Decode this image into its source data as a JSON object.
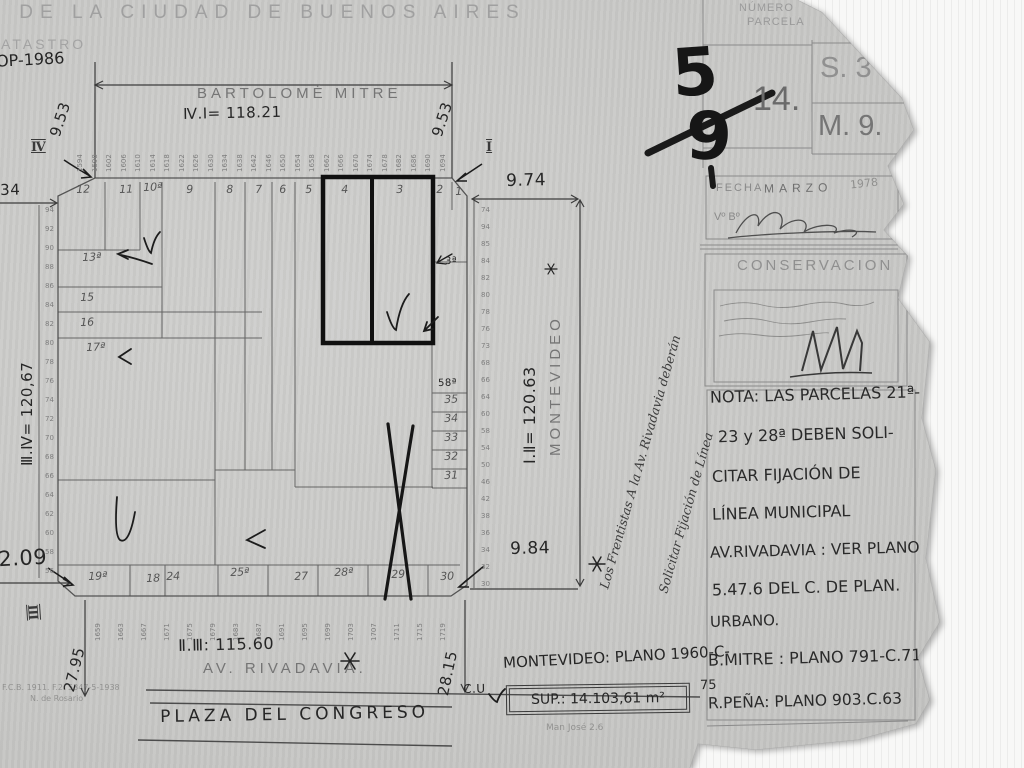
{
  "document": {
    "title": "ID DE LA CIUDAD DE BUENOS AIRES",
    "dept": "CATASTRO",
    "plan_code": "OP-1986",
    "numero_label": "NÚMERO",
    "parcela_label": "PARCELA",
    "hoja_num": "5",
    "hoja_den": "9",
    "circ": "14.",
    "seccion": "S. 3",
    "manzana": "M. 9.",
    "fecha_label": "FECHA",
    "mes": "MARZO",
    "anio": "1978",
    "vb": "Vº Bº",
    "conservacion_title": "CONSERVACION"
  },
  "nota": {
    "lines": [
      {
        "t": "NOTA: LAS PARCELAS 21ª-",
        "x": 710,
        "y": 385,
        "s": 16
      },
      {
        "t": "23 y 28ª DEBEN SOLI-",
        "x": 718,
        "y": 425,
        "s": 16
      },
      {
        "t": "CITAR FIJACIÓN DE",
        "x": 712,
        "y": 465,
        "s": 16
      },
      {
        "t": "LÍNEA MUNICIPAL",
        "x": 712,
        "y": 503,
        "s": 16
      },
      {
        "t": "AV.RIVADAVIA : VER PLANO",
        "x": 710,
        "y": 541,
        "s": 15.5
      },
      {
        "t": "5.47.6 DEL C. DE PLAN.",
        "x": 712,
        "y": 578,
        "s": 16
      },
      {
        "t": "URBANO.",
        "x": 710,
        "y": 612,
        "s": 15
      },
      {
        "t": "B.MITRE : PLANO 791-C.71",
        "x": 708,
        "y": 648,
        "s": 16
      },
      {
        "t": "75",
        "x": 700,
        "y": 678,
        "s": 13
      },
      {
        "t": "R.PEÑA: PLANO 903.C.63",
        "x": 708,
        "y": 692,
        "s": 15.5
      }
    ]
  },
  "annotations": {
    "montevideo_plano": "MONTEVIDEO: PLANO 1960-C-",
    "sup": "SUP.: 14.103,61 m²",
    "frentistas_line1": "Los Frentistas A la Av. Rivadavia deberán",
    "frentistas_line2": "Solicitar Fijación de Línea"
  },
  "plan": {
    "streets": {
      "top": "BARTOLOMÉ MITRE",
      "right": "MONTEVIDEO",
      "bottom": "AV. RIVADAVIA.",
      "plaza": "PLAZA DEL CONGRESO"
    },
    "labels": [
      {
        "t": "BARTOLOMÉ MITRE",
        "x": 197,
        "y": 86,
        "s": 15,
        "c": "print"
      },
      {
        "t": "Ⅳ.Ⅰ= 118.21",
        "x": 183,
        "y": 107,
        "s": 15,
        "c": "hand"
      },
      {
        "t": "MONTEVIDEO",
        "x": 548,
        "y": 456,
        "s": 15,
        "r": -90,
        "c": "print"
      },
      {
        "t": "Ⅰ.Ⅱ= 120.63",
        "x": 522,
        "y": 464,
        "s": 16,
        "r": -90,
        "c": "hand"
      },
      {
        "t": "AV. RIVADAVIA.",
        "x": 203,
        "y": 661,
        "s": 15,
        "c": "print"
      },
      {
        "t": "Ⅱ.Ⅲ: 115.60",
        "x": 178,
        "y": 638,
        "s": 16,
        "c": "hand"
      },
      {
        "t": "PLAZA DEL CONGRESO",
        "x": 160,
        "y": 709,
        "s": 17,
        "c": "hand2"
      },
      {
        "t": "9.53",
        "x": 48,
        "y": 134,
        "s": 15,
        "r": -72,
        "c": "hand"
      },
      {
        "t": "9.53",
        "x": 430,
        "y": 134,
        "s": 15,
        "r": -72,
        "c": "hand"
      },
      {
        "t": "9.74",
        "x": 506,
        "y": 173,
        "s": 17,
        "c": "hand"
      },
      {
        "t": "9.84",
        "x": 510,
        "y": 541,
        "s": 17,
        "c": "hand"
      },
      {
        "t": "12.09",
        "x": -16,
        "y": 549,
        "s": 21,
        "r": -3,
        "c": "hand"
      },
      {
        "t": "27.95",
        "x": 62,
        "y": 690,
        "s": 15,
        "r": -76,
        "c": "hand"
      },
      {
        "t": "28.15",
        "x": 436,
        "y": 694,
        "s": 15,
        "r": -78,
        "c": "hand"
      },
      {
        "t": "C.U",
        "x": 463,
        "y": 683,
        "s": 12,
        "c": "hand"
      },
      {
        "t": "Ⅳ",
        "x": 31,
        "y": 141,
        "s": 13,
        "c": "roman"
      },
      {
        "t": "Ⅰ",
        "x": 486,
        "y": 141,
        "s": 13,
        "c": "roman"
      },
      {
        "t": "Ⅲ",
        "x": 38,
        "y": 604,
        "s": 13,
        "r": 86,
        "c": "roman"
      },
      {
        "t": "Ⅲ.Ⅳ= 120,67",
        "x": 20,
        "y": 466,
        "s": 15,
        "r": -90,
        "c": "hand"
      },
      {
        "t": "34",
        "x": 0,
        "y": 183,
        "s": 15,
        "c": "hand"
      },
      {
        "t": "58ª",
        "x": 438,
        "y": 379,
        "s": 10,
        "c": "hand"
      },
      {
        "t": "3ª",
        "x": 445,
        "y": 257,
        "s": 10,
        "c": "hand"
      },
      {
        "t": "F.C.B. 1911. F.2. 5347-5-1938",
        "x": 2,
        "y": 684,
        "s": 8,
        "c": "pencil"
      },
      {
        "t": "N. de Rosario",
        "x": 30,
        "y": 695,
        "s": 8,
        "c": "pencil"
      },
      {
        "t": "Man José 2.6",
        "x": 546,
        "y": 724,
        "s": 9,
        "c": "pencil"
      }
    ],
    "parcels": [
      {
        "t": "12",
        "x": 76,
        "y": 184
      },
      {
        "t": "11",
        "x": 119,
        "y": 184
      },
      {
        "t": "10ª",
        "x": 143,
        "y": 182
      },
      {
        "t": "9",
        "x": 186,
        "y": 184
      },
      {
        "t": "8",
        "x": 226,
        "y": 184
      },
      {
        "t": "7",
        "x": 255,
        "y": 184
      },
      {
        "t": "6",
        "x": 279,
        "y": 184
      },
      {
        "t": "5",
        "x": 305,
        "y": 184
      },
      {
        "t": "4",
        "x": 341,
        "y": 184
      },
      {
        "t": "3",
        "x": 396,
        "y": 184
      },
      {
        "t": "2",
        "x": 436,
        "y": 184
      },
      {
        "t": "1",
        "x": 455,
        "y": 186
      },
      {
        "t": "13ª",
        "x": 82,
        "y": 252
      },
      {
        "t": "15",
        "x": 80,
        "y": 292
      },
      {
        "t": "16",
        "x": 80,
        "y": 317
      },
      {
        "t": "17ª",
        "x": 86,
        "y": 342
      },
      {
        "t": "19ª",
        "x": 88,
        "y": 571
      },
      {
        "t": "18",
        "x": 146,
        "y": 573
      },
      {
        "t": "24",
        "x": 166,
        "y": 571
      },
      {
        "t": "25ª",
        "x": 230,
        "y": 567
      },
      {
        "t": "27",
        "x": 294,
        "y": 571
      },
      {
        "t": "28ª",
        "x": 334,
        "y": 567
      },
      {
        "t": "29",
        "x": 391,
        "y": 569
      },
      {
        "t": "30",
        "x": 440,
        "y": 571
      },
      {
        "t": "35",
        "x": 444,
        "y": 394
      },
      {
        "t": "34",
        "x": 444,
        "y": 413
      },
      {
        "t": "33",
        "x": 444,
        "y": 432
      },
      {
        "t": "32",
        "x": 444,
        "y": 451
      },
      {
        "t": "31",
        "x": 444,
        "y": 470
      }
    ],
    "house_numbers": {
      "top": [
        "1594",
        "1598",
        "1602",
        "1606",
        "1610",
        "1614",
        "1618",
        "1622",
        "1626",
        "1630",
        "1634",
        "1638",
        "1642",
        "1646",
        "1650",
        "1654",
        "1658",
        "1662",
        "1666",
        "1670",
        "1674",
        "1678",
        "1682",
        "1686",
        "1690",
        "1694"
      ],
      "bottom": [
        "1659",
        "1663",
        "1667",
        "1671",
        "1675",
        "1679",
        "1683",
        "1687",
        "1691",
        "1695",
        "1699",
        "1703",
        "1707",
        "1711",
        "1715",
        "1719"
      ],
      "left": [
        "94",
        "92",
        "90",
        "88",
        "86",
        "84",
        "82",
        "80",
        "78",
        "76",
        "74",
        "72",
        "70",
        "68",
        "66",
        "64",
        "62",
        "60",
        "58",
        "56"
      ],
      "right": [
        "74",
        "94",
        "85",
        "84",
        "82",
        "80",
        "78",
        "76",
        "73",
        "68",
        "66",
        "64",
        "60",
        "58",
        "54",
        "50",
        "46",
        "42",
        "38",
        "36",
        "34",
        "32",
        "30"
      ]
    }
  }
}
